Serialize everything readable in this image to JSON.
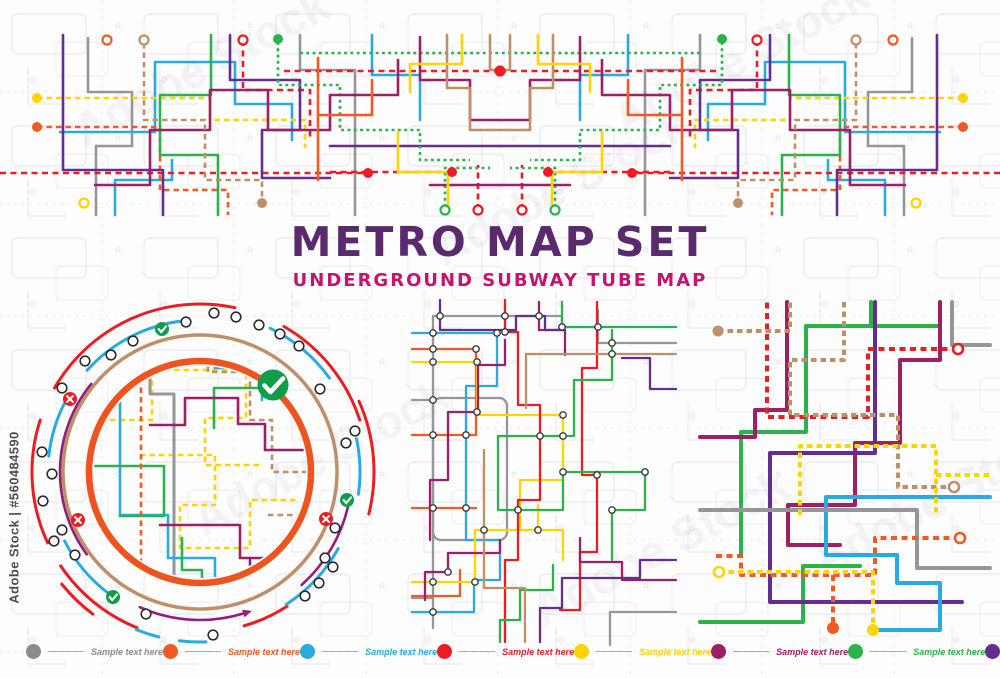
{
  "poster": {
    "title": "METRO MAP SET",
    "subtitle": "UNDERGROUND SUBWAY TUBE MAP"
  },
  "watermark": {
    "side_text": "Adobe Stock | #560484590",
    "ghost_text": "Adobe Stock"
  },
  "palette": {
    "red": "#ED1C24",
    "orange": "#F15A24",
    "blue": "#29ABE2",
    "yellow": "#FFD400",
    "green": "#2BB24C",
    "magenta": "#9E1F63",
    "purple": "#662D91",
    "tan": "#BF9068",
    "gray": "#95969A",
    "arc_purple": "#941B80",
    "ring_orange": "#F0541E",
    "badge_green": "#0F9D49",
    "title_color": "#5B2A6E",
    "subtitle_color": "#C2156B"
  },
  "legend": {
    "items": [
      {
        "label": "Sample text here",
        "color": "#8A8C8E"
      },
      {
        "label": "Sample text here",
        "color": "#F15A24"
      },
      {
        "label": "Sample text here",
        "color": "#29ABE2"
      },
      {
        "label": "Sample text here",
        "color": "#ED1C24"
      },
      {
        "label": "Sample text here",
        "color": "#FFD400"
      },
      {
        "label": "Sample text here",
        "color": "#9E1F63"
      },
      {
        "label": "Sample text here",
        "color": "#2BB24C"
      },
      {
        "label": "Sample text here",
        "color": "#662D91"
      },
      {
        "label": "Sample text here",
        "color": "#BF9068"
      }
    ]
  }
}
